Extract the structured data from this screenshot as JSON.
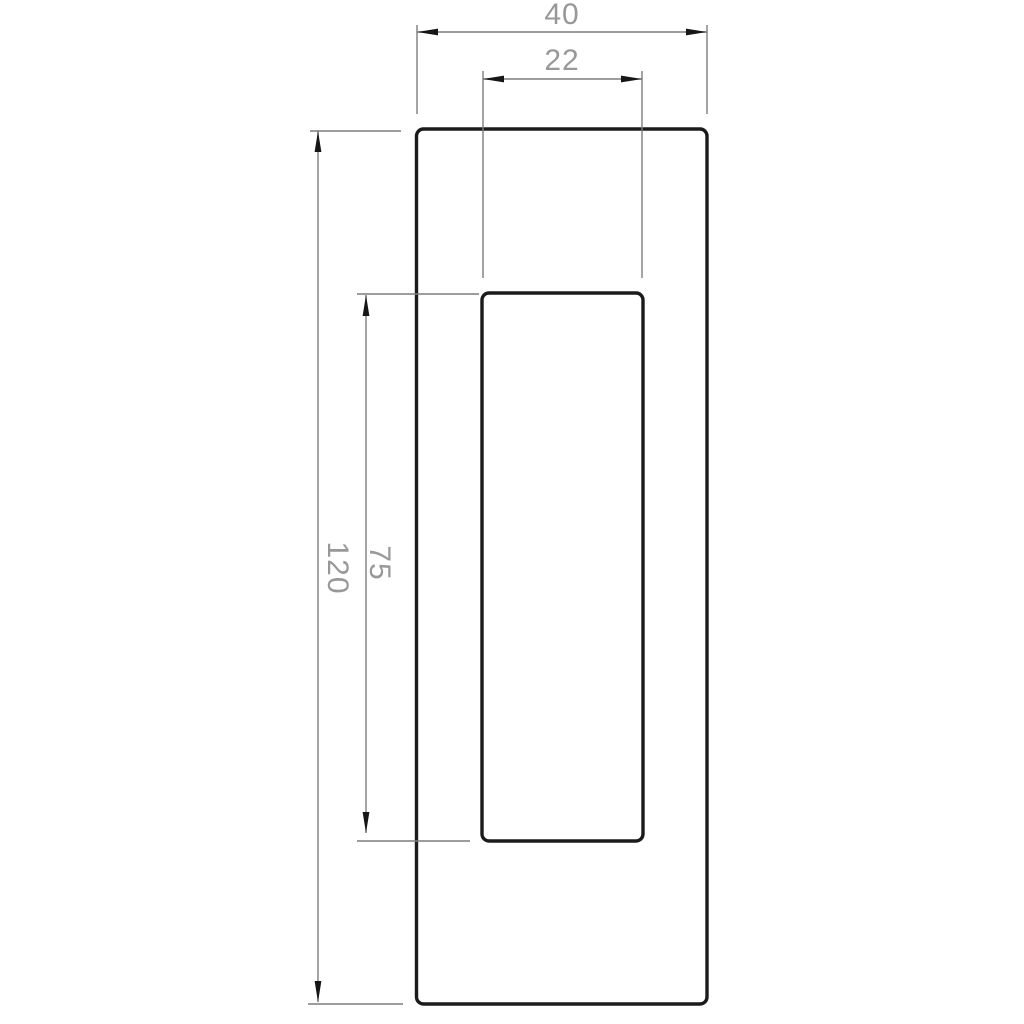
{
  "drawing": {
    "type": "technical-dimension-drawing",
    "dimensions": [
      {
        "id": "outer-width",
        "label": "40",
        "orientation": "horizontal"
      },
      {
        "id": "inner-width",
        "label": "22",
        "orientation": "horizontal"
      },
      {
        "id": "outer-height",
        "label": "120",
        "orientation": "vertical"
      },
      {
        "id": "inner-height",
        "label": "75",
        "orientation": "vertical"
      }
    ],
    "shapes": [
      {
        "id": "outer-rectangle",
        "width_label": "40",
        "height_label": "120"
      },
      {
        "id": "inner-rectangle",
        "width_label": "22",
        "height_label": "75"
      }
    ],
    "colors": {
      "background": "#ffffff",
      "object_line": "#1b1b1b",
      "dimension_line": "#7d7d7d",
      "dimension_text": "#989898",
      "arrowhead": "#161616"
    }
  }
}
